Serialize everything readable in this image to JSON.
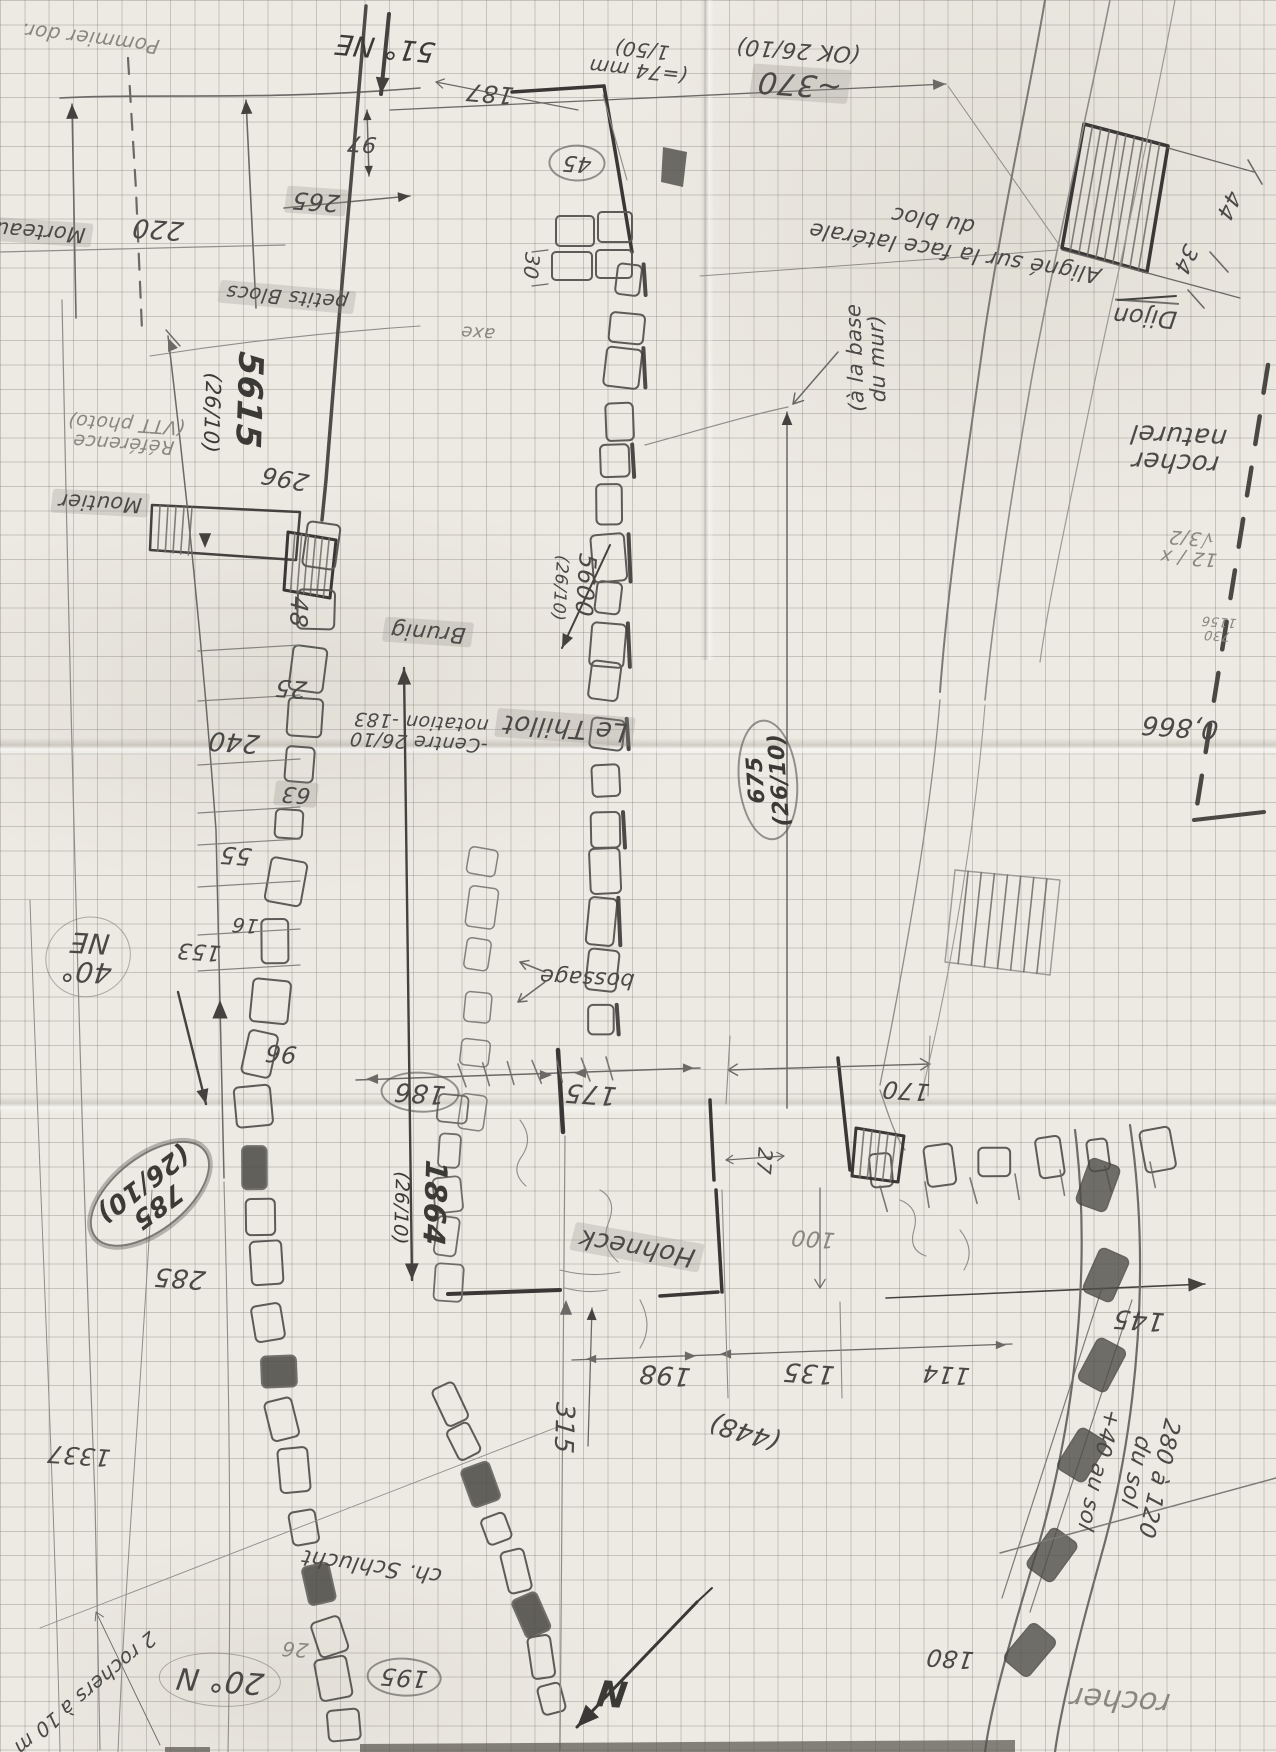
{
  "paper": {
    "background": "#edeae3",
    "grid_color": "#7a7872",
    "pencil": "#4a4947",
    "pencil_bold": "#3b3a36",
    "pencil_light": "#8a8781",
    "highlight": "#92908a"
  },
  "document": {
    "kind": "hand-drawn field survey sketch on graph paper",
    "language": "French"
  },
  "labels": [
    {
      "id": "pommier",
      "t": "Pommier dor.",
      "x": 90,
      "y": 38,
      "r": 187,
      "s": 20,
      "w": 400,
      "c": "#8a8781"
    },
    {
      "id": "morteau",
      "t": "Morteau",
      "x": 40,
      "y": 232,
      "r": 184,
      "s": 21,
      "w": 400,
      "st": "hl"
    },
    {
      "id": "dim-220",
      "t": "220",
      "x": 158,
      "y": 228,
      "r": 184,
      "s": 26,
      "w": 400
    },
    {
      "id": "bearing-51ne",
      "t": "51° NE",
      "x": 385,
      "y": 48,
      "r": 185,
      "s": 28,
      "w": 500,
      "c": "#3b3a36"
    },
    {
      "id": "dim-97",
      "t": "97",
      "x": 362,
      "y": 143,
      "r": 184,
      "s": 22,
      "w": 400
    },
    {
      "id": "dim-265",
      "t": "265",
      "x": 316,
      "y": 201,
      "r": 184,
      "s": 24,
      "w": 400,
      "st": "hl"
    },
    {
      "id": "dim-187",
      "t": "187",
      "x": 490,
      "y": 93,
      "r": 185,
      "s": 24,
      "w": 400
    },
    {
      "id": "dim-45",
      "t": "45",
      "x": 577,
      "y": 163,
      "r": 184,
      "s": 22,
      "w": 400,
      "st": "circ"
    },
    {
      "id": "scale-74mm",
      "t": "(=74 mm\n1/50)",
      "x": 640,
      "y": 60,
      "r": 186,
      "s": 20,
      "w": 400
    },
    {
      "id": "ok-2610",
      "t": "(OK 26/10)",
      "x": 798,
      "y": 50,
      "r": 184,
      "s": 22,
      "w": 400
    },
    {
      "id": "dim-370",
      "t": "~370",
      "x": 800,
      "y": 84,
      "r": 184,
      "s": 30,
      "w": 500,
      "st": "hl"
    },
    {
      "id": "aligne-note",
      "t": "Aligné sur la face latérale",
      "x": 955,
      "y": 252,
      "r": 189,
      "s": 22,
      "w": 400
    },
    {
      "id": "aligne-note2",
      "t": "du bloc",
      "x": 933,
      "y": 220,
      "r": 189,
      "s": 22,
      "w": 400
    },
    {
      "id": "dijon",
      "t": "Dijon",
      "x": 1145,
      "y": 315,
      "r": 184,
      "s": 24,
      "w": 500,
      "st": "ul"
    },
    {
      "id": "dim-44",
      "t": "44",
      "x": 1228,
      "y": 205,
      "r": 115,
      "s": 22,
      "w": 400
    },
    {
      "id": "dim-34",
      "t": "34",
      "x": 1185,
      "y": 259,
      "r": 115,
      "s": 22,
      "w": 400
    },
    {
      "id": "rocher-naturel",
      "t": "rocher\nnaturel",
      "x": 1177,
      "y": 448,
      "r": 183,
      "s": 26,
      "w": 400
    },
    {
      "id": "calc-sqrt",
      "t": "12 / x √3/2",
      "x": 1190,
      "y": 547,
      "r": 184,
      "s": 19,
      "w": 400,
      "c": "#8a8781"
    },
    {
      "id": "calc-frac",
      "t": "730\n1156",
      "x": 1218,
      "y": 628,
      "r": 184,
      "s": 13,
      "w": 400,
      "c": "#8a8781"
    },
    {
      "id": "calc-0866",
      "t": "0,866",
      "x": 1180,
      "y": 726,
      "r": 184,
      "s": 26,
      "w": 400
    },
    {
      "id": "petits-blocs",
      "t": "petits Blocs",
      "x": 287,
      "y": 297,
      "r": 185,
      "s": 20,
      "w": 400,
      "st": "hl"
    },
    {
      "id": "reference-photo",
      "t": "Référence\n(VTT photo)",
      "x": 125,
      "y": 433,
      "r": 184,
      "s": 19,
      "w": 400,
      "c": "#8a8781"
    },
    {
      "id": "moutier",
      "t": "Moutier",
      "x": 100,
      "y": 503,
      "r": 183,
      "s": 21,
      "w": 400,
      "st": "hl"
    },
    {
      "id": "dim-5615",
      "t": "5615",
      "x": 248,
      "y": 400,
      "r": 92,
      "s": 34,
      "w": 700,
      "c": "#3b3a36"
    },
    {
      "id": "dim-5615-date",
      "t": "(26/10)",
      "x": 212,
      "y": 413,
      "r": 92,
      "s": 21,
      "w": 500,
      "c": "#3b3a36"
    },
    {
      "id": "dim-296",
      "t": "296",
      "x": 285,
      "y": 478,
      "r": 190,
      "s": 24,
      "w": 400
    },
    {
      "id": "dim-48",
      "t": "48",
      "x": 298,
      "y": 612,
      "r": 92,
      "s": 24,
      "w": 400
    },
    {
      "id": "brunig",
      "t": "Brunig",
      "x": 428,
      "y": 632,
      "r": 184,
      "s": 22,
      "w": 400,
      "st": "hl"
    },
    {
      "id": "dim-5600",
      "t": "5600",
      "x": 585,
      "y": 585,
      "r": 94,
      "s": 24,
      "w": 400
    },
    {
      "id": "dim-5600-date",
      "t": "(26/10)",
      "x": 559,
      "y": 588,
      "r": 94,
      "s": 17,
      "w": 400
    },
    {
      "id": "le-thillot",
      "t": "Le Thillot",
      "x": 565,
      "y": 727,
      "r": 184,
      "s": 26,
      "w": 400,
      "st": "hl"
    },
    {
      "id": "centre-note",
      "t": "-Centre 26/10\nnotation -183",
      "x": 420,
      "y": 731,
      "r": 183,
      "s": 19,
      "w": 400
    },
    {
      "id": "dim-25",
      "t": "25",
      "x": 291,
      "y": 688,
      "r": 184,
      "s": 24,
      "w": 400
    },
    {
      "id": "dim-240",
      "t": "240",
      "x": 234,
      "y": 741,
      "r": 184,
      "s": 26,
      "w": 400
    },
    {
      "id": "dim-63",
      "t": "63",
      "x": 296,
      "y": 794,
      "r": 184,
      "s": 22,
      "w": 400,
      "st": "hl"
    },
    {
      "id": "dim-55",
      "t": "55",
      "x": 236,
      "y": 855,
      "r": 184,
      "s": 24,
      "w": 400
    },
    {
      "id": "dim-16",
      "t": "16",
      "x": 245,
      "y": 925,
      "r": 184,
      "s": 20,
      "w": 400
    },
    {
      "id": "dim-153",
      "t": "153",
      "x": 199,
      "y": 951,
      "r": 184,
      "s": 22,
      "w": 400
    },
    {
      "id": "dim-96",
      "t": "96",
      "x": 281,
      "y": 1053,
      "r": 184,
      "s": 24,
      "w": 400
    },
    {
      "id": "bearing-40ne",
      "t": "40°\nNE",
      "x": 88,
      "y": 957,
      "r": 183,
      "s": 28,
      "w": 500,
      "st": "circL"
    },
    {
      "id": "dim-785",
      "t": "785\n(26/10)",
      "x": 150,
      "y": 1194,
      "r": 143,
      "s": 26,
      "w": 600,
      "c": "#3b3a36",
      "st": "circ2"
    },
    {
      "id": "dim-285",
      "t": "285",
      "x": 180,
      "y": 1277,
      "r": 184,
      "s": 26,
      "w": 400
    },
    {
      "id": "dim-1337",
      "t": "1337",
      "x": 79,
      "y": 1455,
      "r": 184,
      "s": 24,
      "w": 400
    },
    {
      "id": "dim-186",
      "t": "186",
      "x": 420,
      "y": 1092,
      "r": 184,
      "s": 26,
      "w": 400,
      "st": "circ"
    },
    {
      "id": "dim-175",
      "t": "175",
      "x": 591,
      "y": 1093,
      "r": 184,
      "s": 26,
      "w": 400
    },
    {
      "id": "bossage",
      "t": "bossage",
      "x": 587,
      "y": 978,
      "r": 183,
      "s": 22,
      "w": 400
    },
    {
      "id": "dim-1864",
      "t": "1864",
      "x": 434,
      "y": 1203,
      "r": 92,
      "s": 30,
      "w": 700,
      "c": "#3b3a36"
    },
    {
      "id": "dim-1864-date",
      "t": "(26/10)",
      "x": 400,
      "y": 1208,
      "r": 92,
      "s": 19,
      "w": 500,
      "c": "#3b3a36"
    },
    {
      "id": "hohneck",
      "t": "Hohneck",
      "x": 637,
      "y": 1247,
      "r": 190,
      "s": 26,
      "w": 400,
      "st": "hl"
    },
    {
      "id": "dim-27",
      "t": "27",
      "x": 764,
      "y": 1161,
      "r": 95,
      "s": 20,
      "w": 400
    },
    {
      "id": "dim-675",
      "t": "675\n(26/10)",
      "x": 768,
      "y": 780,
      "r": -94,
      "s": 22,
      "w": 600,
      "c": "#3b3a36",
      "st": "circ"
    },
    {
      "id": "a-la-base",
      "t": "(à la base\ndu mur)",
      "x": 866,
      "y": 358,
      "r": -92,
      "s": 21,
      "w": 400
    },
    {
      "id": "dim-170",
      "t": "170",
      "x": 906,
      "y": 1090,
      "r": 184,
      "s": 24,
      "w": 400
    },
    {
      "id": "dim-100",
      "t": "100",
      "x": 813,
      "y": 1238,
      "r": 184,
      "s": 22,
      "w": 400,
      "c": "#8a8781"
    },
    {
      "id": "dim-198",
      "t": "198",
      "x": 665,
      "y": 1374,
      "r": 184,
      "s": 26,
      "w": 400
    },
    {
      "id": "dim-135",
      "t": "135",
      "x": 809,
      "y": 1372,
      "r": 184,
      "s": 26,
      "w": 400
    },
    {
      "id": "dim-114",
      "t": "114",
      "x": 946,
      "y": 1374,
      "r": 184,
      "s": 24,
      "w": 400
    },
    {
      "id": "dim-448",
      "t": "(448)",
      "x": 745,
      "y": 1431,
      "r": 196,
      "s": 26,
      "w": 400
    },
    {
      "id": "dim-145",
      "t": "145",
      "x": 1139,
      "y": 1319,
      "r": 184,
      "s": 26,
      "w": 400
    },
    {
      "id": "note-280-sol",
      "t": "280 à 120 du sol",
      "x": 1147,
      "y": 1475,
      "r": 103,
      "s": 23,
      "w": 400
    },
    {
      "id": "note-40-sol",
      "t": "+40 au sol",
      "x": 1098,
      "y": 1470,
      "r": 103,
      "s": 22,
      "w": 400
    },
    {
      "id": "dim-180",
      "t": "180",
      "x": 950,
      "y": 1658,
      "r": 184,
      "s": 24,
      "w": 400
    },
    {
      "id": "rocher-bottom",
      "t": "rocher",
      "x": 1120,
      "y": 1700,
      "r": 184,
      "s": 30,
      "w": 400,
      "c": "#8a8781"
    },
    {
      "id": "bearing-20n",
      "t": "20° N",
      "x": 220,
      "y": 1680,
      "r": 184,
      "s": 30,
      "w": 400,
      "st": "circL"
    },
    {
      "id": "note-2-rochers",
      "t": "2 rochers à 10 m",
      "x": 85,
      "y": 1693,
      "r": 140,
      "s": 20,
      "w": 400
    },
    {
      "id": "ch-schlucht",
      "t": "ch. Schlucht",
      "x": 372,
      "y": 1566,
      "r": 188,
      "s": 22,
      "w": 400
    },
    {
      "id": "dim-26",
      "t": "26",
      "x": 295,
      "y": 1649,
      "r": 184,
      "s": 20,
      "w": 400,
      "c": "#8a8781"
    },
    {
      "id": "dim-195",
      "t": "195",
      "x": 404,
      "y": 1677,
      "r": 184,
      "s": 24,
      "w": 400,
      "st": "circ"
    },
    {
      "id": "north-letter",
      "t": "N",
      "x": 612,
      "y": 1692,
      "r": 184,
      "s": 36,
      "w": 700,
      "c": "#3b3a36"
    },
    {
      "id": "dim-30",
      "t": "30",
      "x": 531,
      "y": 266,
      "r": 95,
      "s": 20,
      "w": 400
    },
    {
      "id": "axe",
      "t": "axe",
      "x": 478,
      "y": 332,
      "r": 184,
      "s": 18,
      "w": 400,
      "c": "#8a8781"
    },
    {
      "id": "dim-315",
      "t": "315",
      "x": 563,
      "y": 1428,
      "r": 92,
      "s": 26,
      "w": 400
    }
  ]
}
